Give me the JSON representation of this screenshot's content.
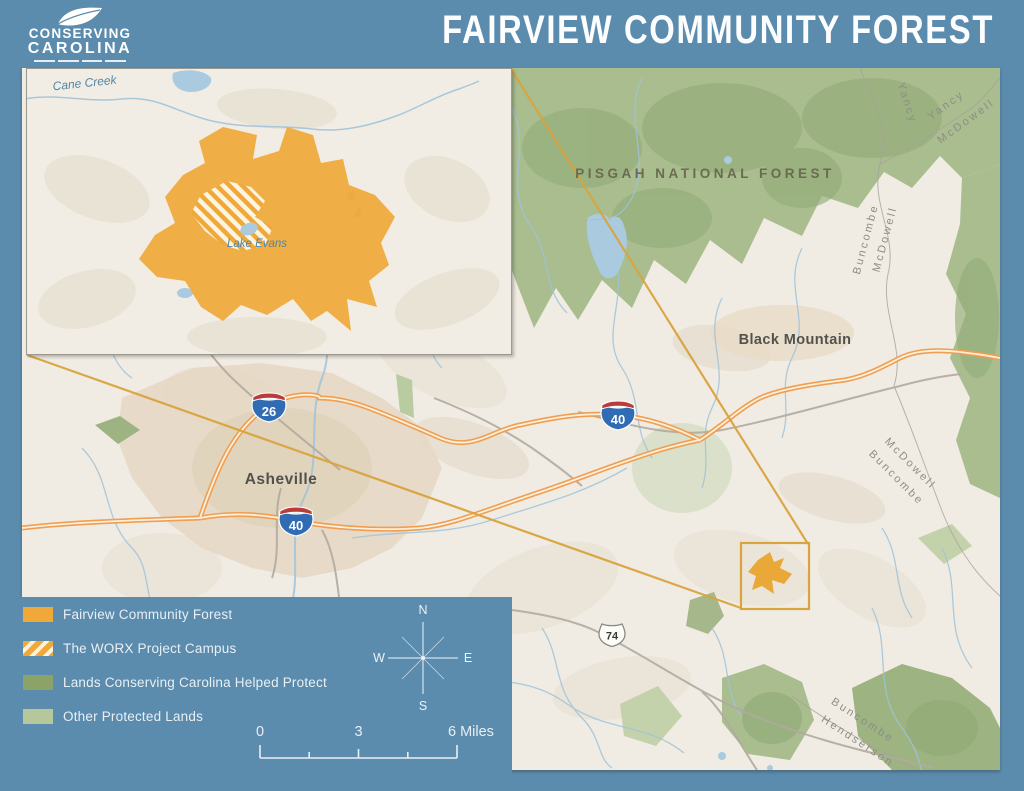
{
  "header": {
    "logo_line1": "CONSERVING",
    "logo_line2": "CAROLINA",
    "title": "FAIRVIEW COMMUNITY FOREST"
  },
  "inset": {
    "creek_label": "Cane Creek",
    "lake_label": "Lake Evans"
  },
  "map": {
    "forest_label": "PISGAH NATIONAL FOREST",
    "town_label": "Black Mountain",
    "city_label": "Asheville",
    "shields": {
      "i26": "26",
      "i40": "40",
      "us74": "74"
    },
    "counties": {
      "yancy_edge": "Yancy",
      "yancy_ne": "Yancy",
      "mcdowell_ne": "McDowell",
      "buncombe_e": "Buncombe",
      "mcdowell_e": "McDowell",
      "mcdowell_se": "McDowell",
      "buncombe_se": "Buncombe",
      "buncombe_s": "Buncombe",
      "henderson_s": "Hendserson"
    }
  },
  "legend": {
    "items": [
      {
        "label": "Fairview Community Forest",
        "swatch": "orange"
      },
      {
        "label": "The WORX Project Campus",
        "swatch": "hatch"
      },
      {
        "label": "Lands Conserving Carolina Helped Protect",
        "swatch": "green"
      },
      {
        "label": "Other Protected Lands",
        "swatch": "lightgreen"
      }
    ]
  },
  "compass": {
    "n": "N",
    "e": "E",
    "s": "S",
    "w": "W"
  },
  "scalebar": {
    "zero": "0",
    "mid": "3",
    "end": "6 Miles"
  },
  "colors": {
    "background_blue": "#5b8cad",
    "fairview_orange": "#f0a838",
    "locator_orange": "#d9a33e",
    "helped_protect_green": "#8ca368",
    "other_protected_green": "#b7c79c",
    "map_base": "#f1ece3",
    "water_blue": "#a9cadf",
    "highway_orange": "#ef9e52"
  }
}
